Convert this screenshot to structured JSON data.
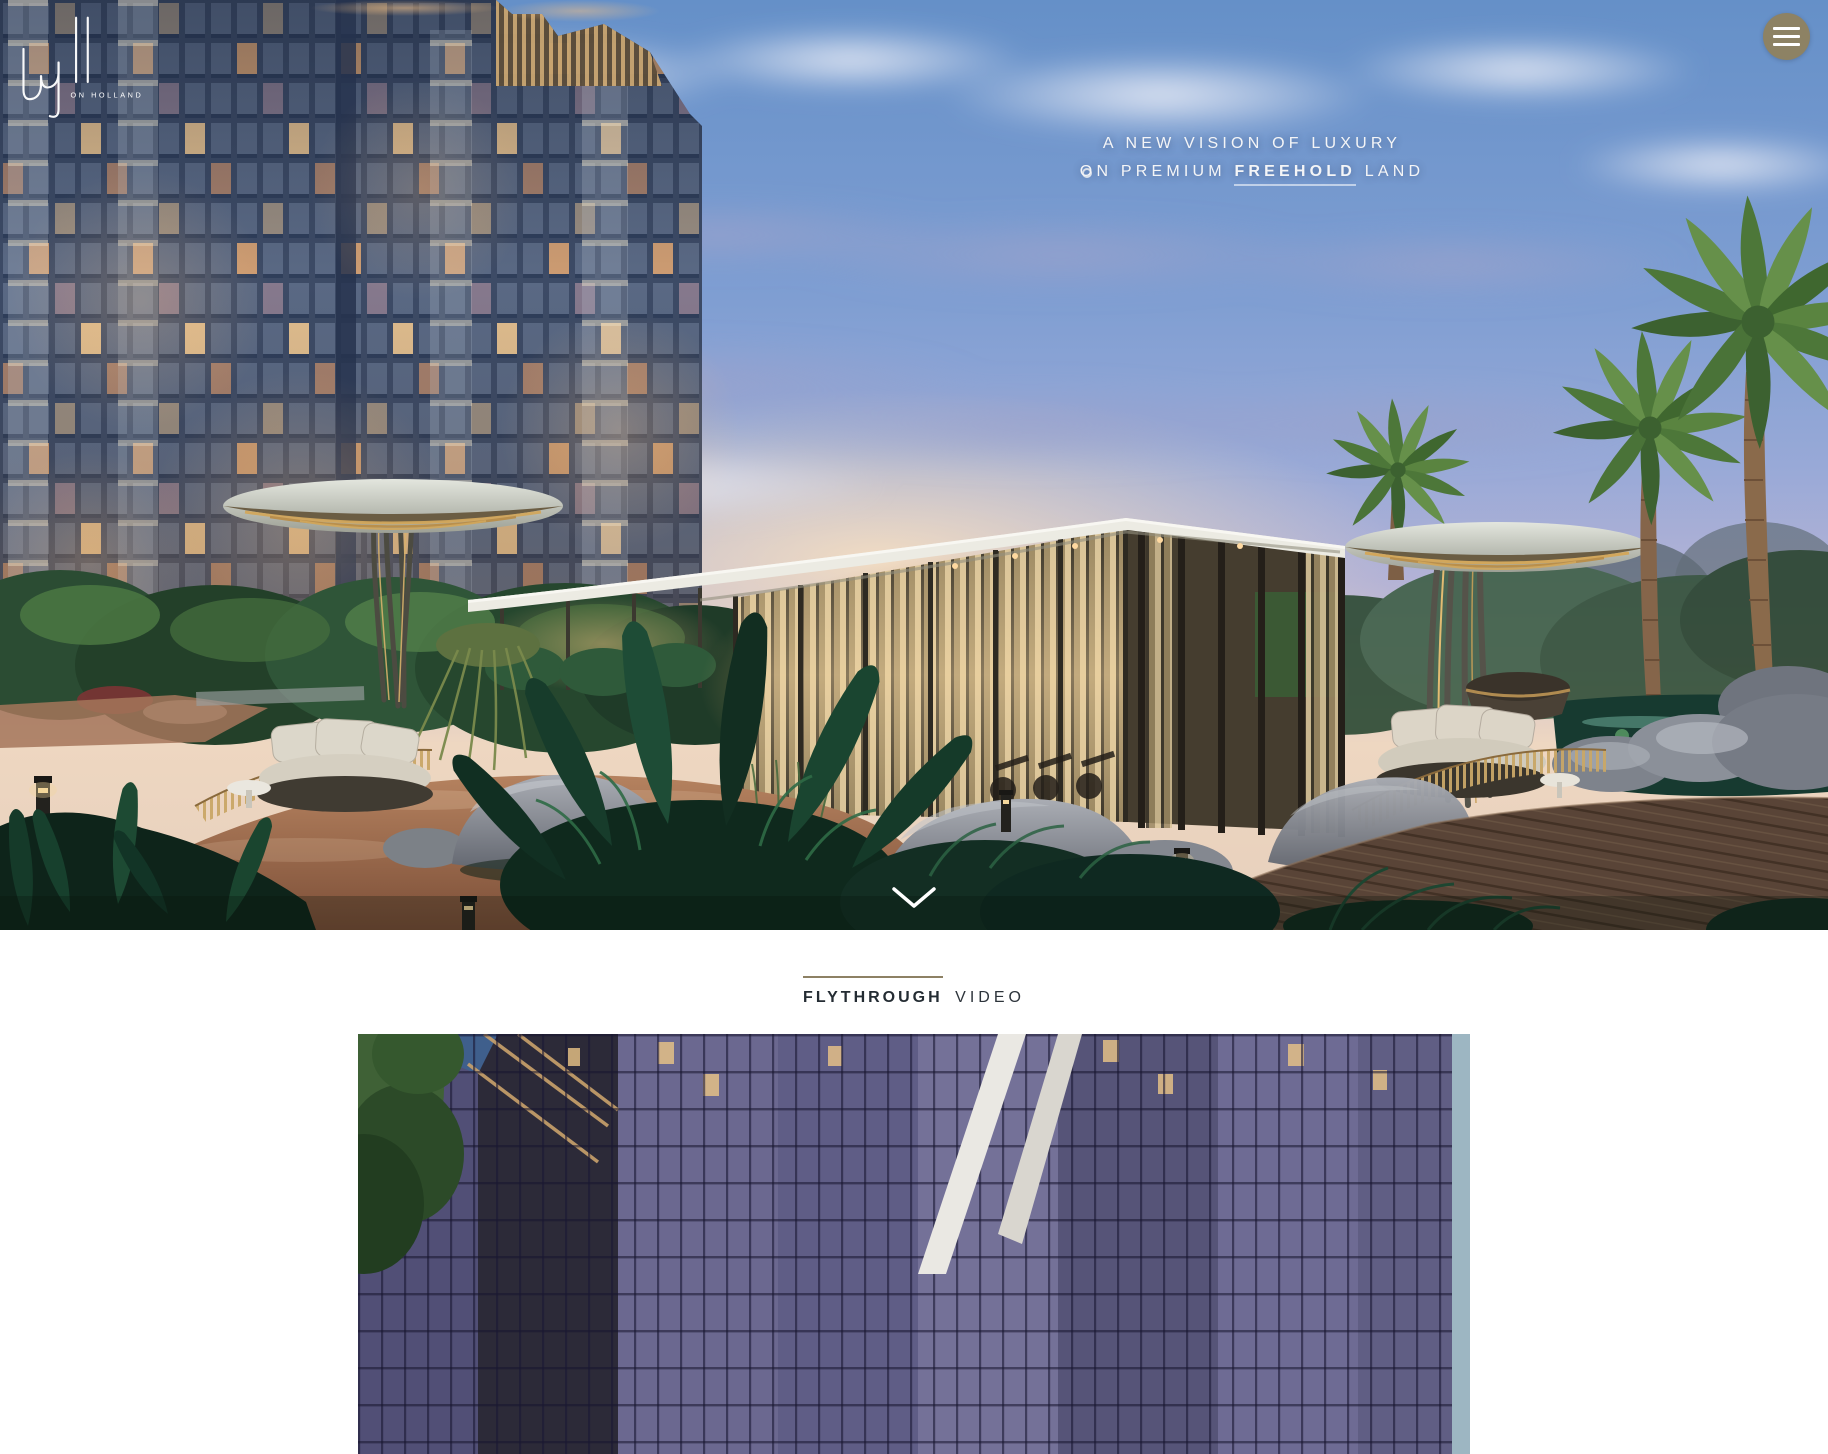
{
  "brand": {
    "name": "hyll",
    "tagline": "ON HOLLAND"
  },
  "hero": {
    "headline_line1": "A NEW VISION OF LUXURY",
    "headline_line2_pre": "ON PREMIUM",
    "headline_line2_bold": "FREEHOLD",
    "headline_line2_post": "LAND"
  },
  "video_section": {
    "title_bold": "FLYTHROUGH",
    "title_regular": "VIDEO"
  },
  "colors": {
    "menu_button_bg": "#8d8264",
    "section_rule": "#8d8164",
    "heading_text": "#242c33",
    "headline_text": "#f4f5f7"
  }
}
